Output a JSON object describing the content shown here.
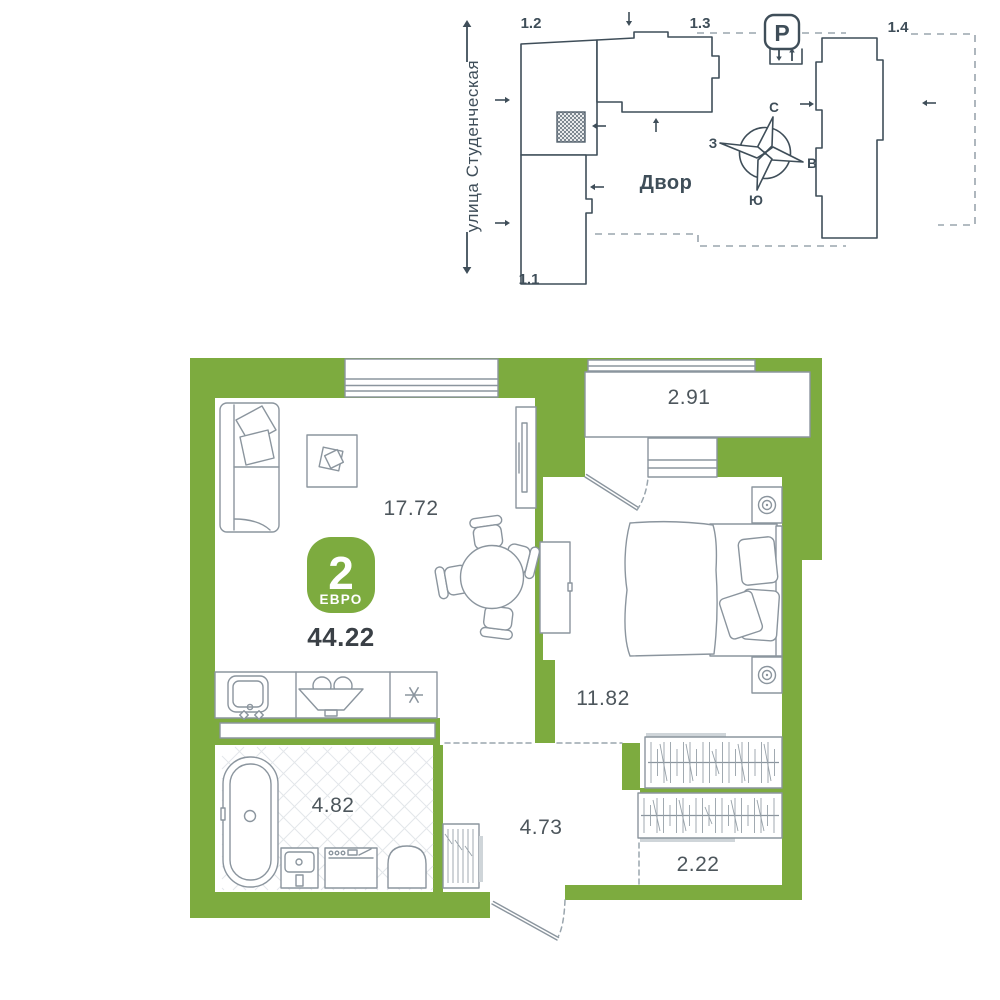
{
  "site_plan": {
    "street_label": "улица Студенческая",
    "yard_label": "Двор",
    "parking": {
      "letter": "P"
    },
    "building_labels": {
      "b11": "1.1",
      "b12": "1.2",
      "b13": "1.3",
      "b14": "1.4"
    },
    "compass": {
      "north": "С",
      "south": "Ю",
      "west": "З",
      "east": "В"
    },
    "icons": {
      "parking": "parking-sign",
      "marker": "apartment-location-hatch",
      "compass": "wind-rose"
    }
  },
  "apartment": {
    "badge": {
      "rooms_count": "2",
      "layout_type": "ЕВРО",
      "total_area": "44.22"
    },
    "room_areas": {
      "living_kitchen": "17.72",
      "loggia": "2.91",
      "bedroom": "11.82",
      "bathroom": "4.82",
      "hallway": "4.73",
      "wardrobe": "2.22"
    },
    "icons": {
      "fridge": "asterisk-snowflake"
    }
  },
  "colors": {
    "accent_green": "#7dab3f",
    "plan_line": "#3f4e59",
    "furniture_line": "#8b959e",
    "label_text": "#4d565c",
    "area_text": "#3a4046"
  }
}
